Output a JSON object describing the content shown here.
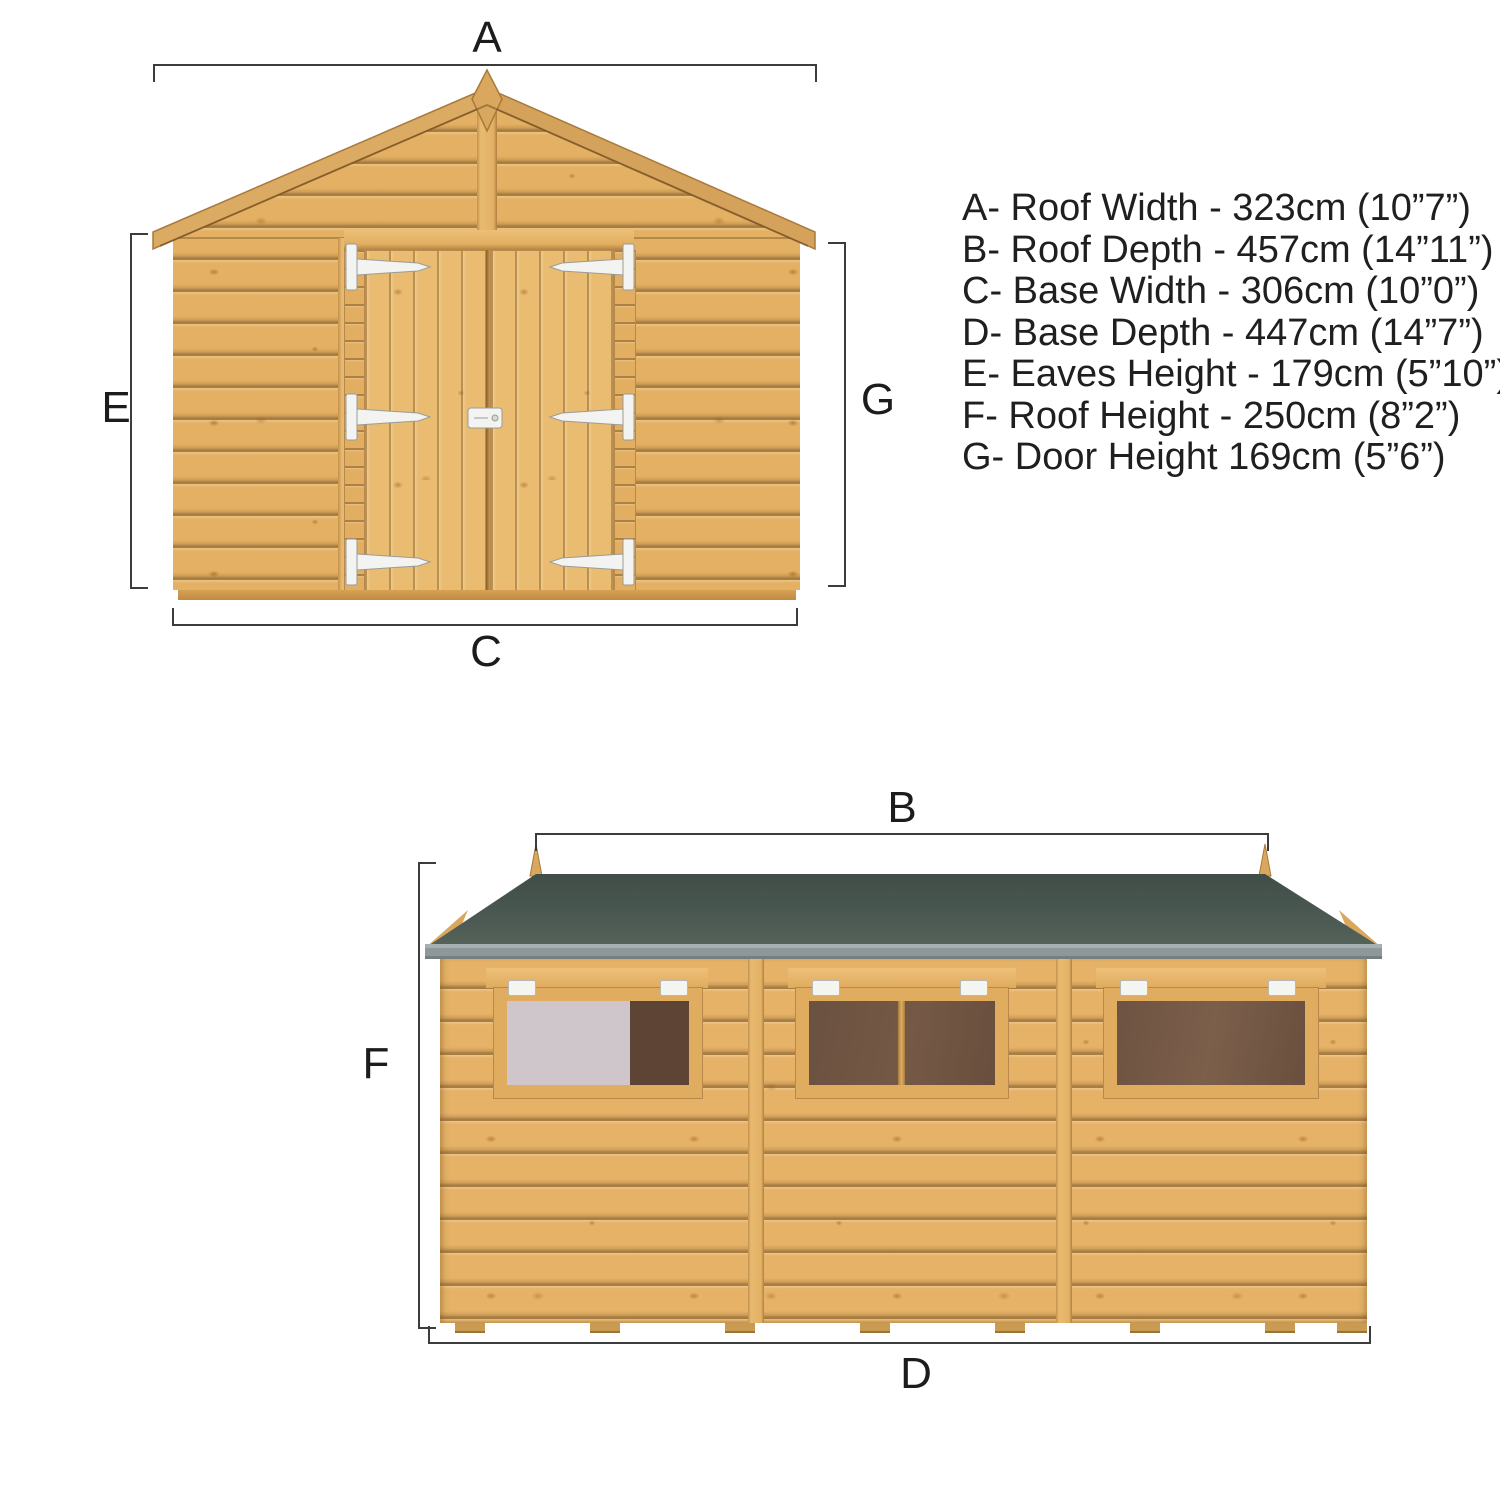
{
  "diagram_title": "Shed dimension diagram (front and side elevations)",
  "dims": {
    "roof_width_label": "A",
    "roof_depth_label": "B",
    "base_width_label": "C",
    "base_depth_label": "D",
    "eaves_height_label": "E",
    "roof_height_label": "F",
    "door_height_label": "G"
  },
  "specs": {
    "items": [
      "A- Roof Width - 323cm (10”7”)",
      "B- Roof Depth - 457cm (14”11”)",
      "C- Base Width - 306cm (10”0”)",
      "D- Base Depth - 447cm (14”7”)",
      "E- Eaves Height - 179cm (5”10”)",
      "F- Roof Height - 250cm (8”2”)",
      "G- Door Height 169cm (5”6”)"
    ]
  },
  "colors": {
    "background": "#ffffff",
    "wood": "#e4b164",
    "wood_groove": "#5e3e16",
    "wood_trim_edge": "#b9884b",
    "roof_felt": "#4a5852",
    "roof_edge_grit": "#8e989a",
    "pane_dark": "#63493a",
    "pane_light": "#cfc6cb",
    "hardware_white": "#f3f3f1",
    "dimension_line": "#3c3c3c",
    "text": "#1f1f1f"
  }
}
